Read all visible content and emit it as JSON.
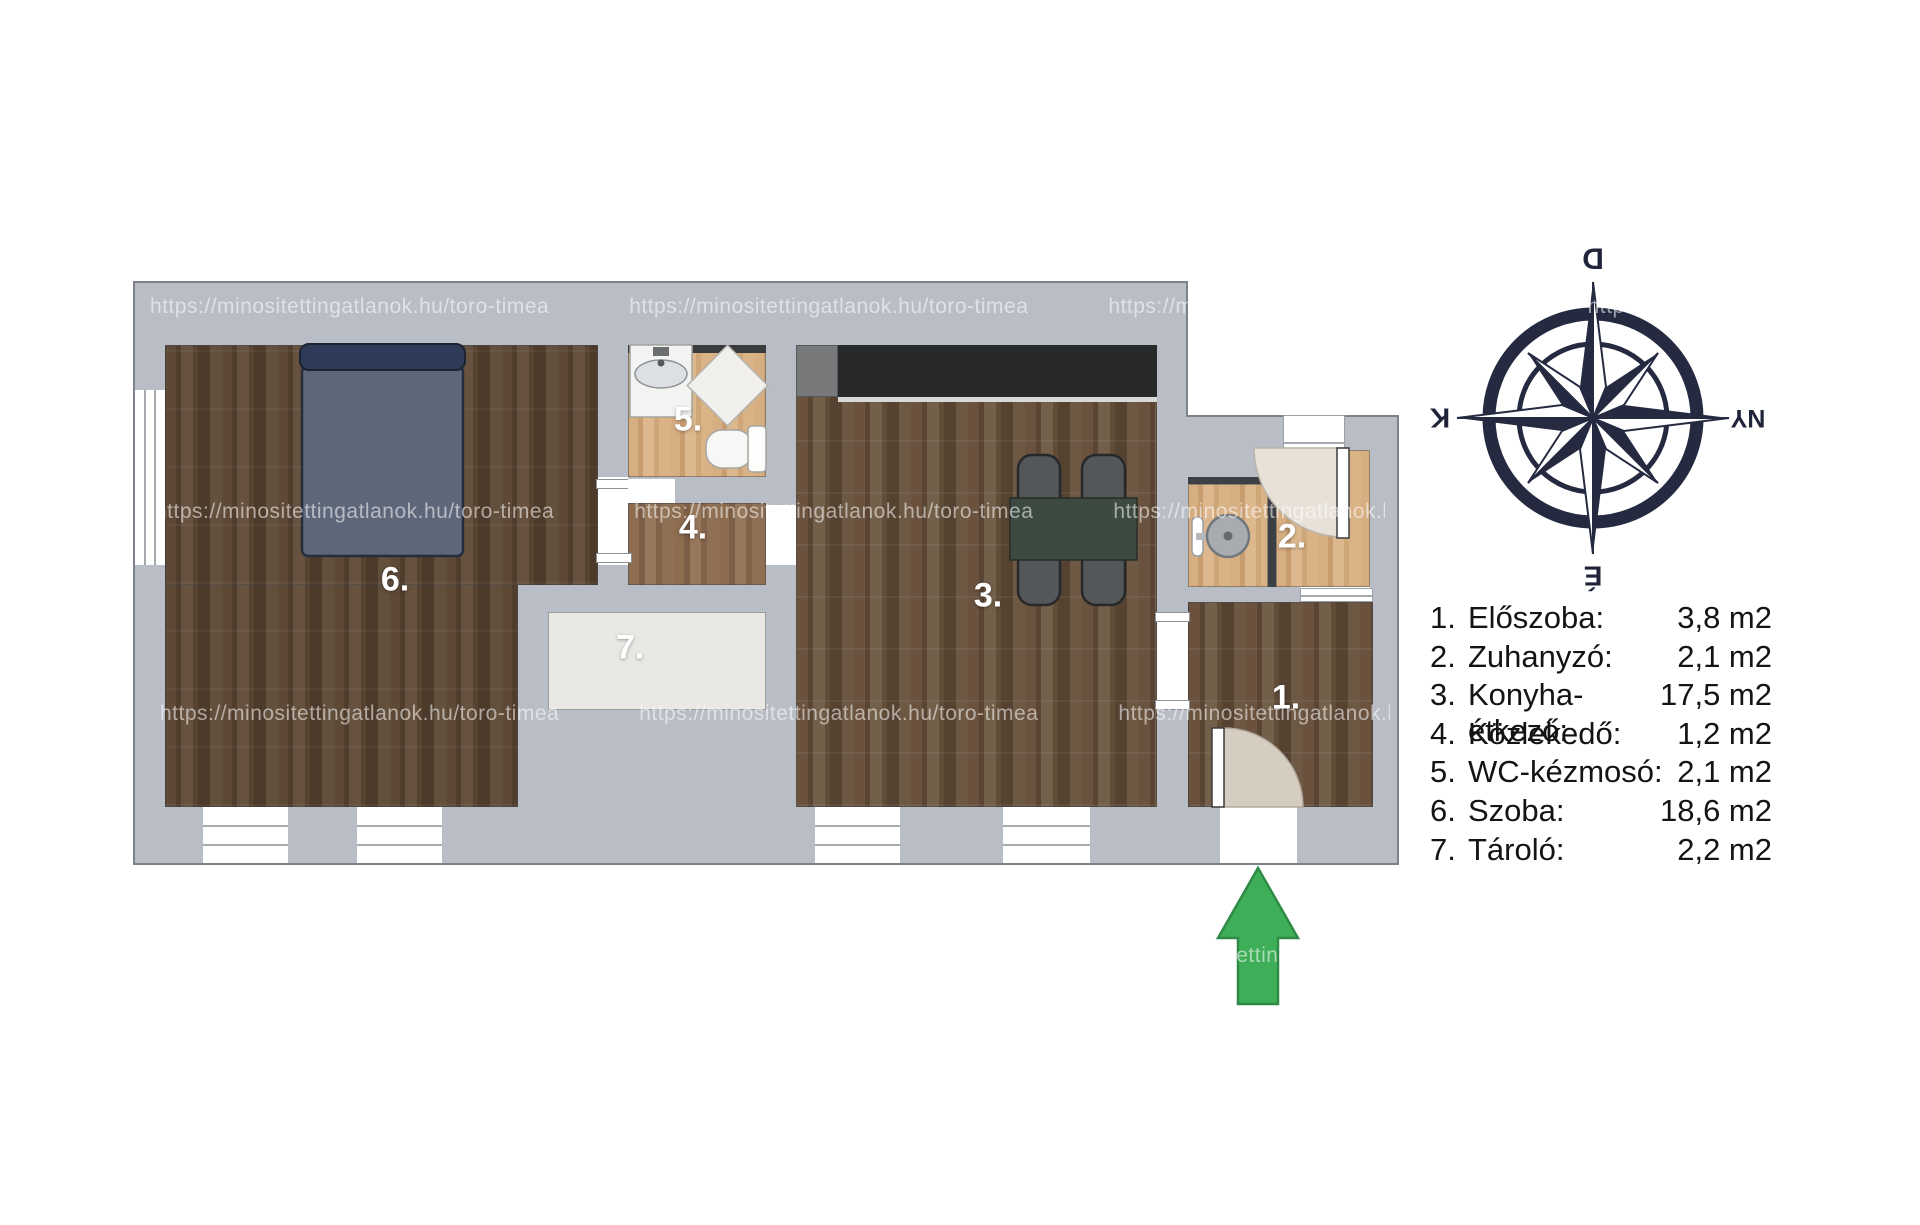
{
  "watermark": {
    "text": "https://minositettingatlanok.hu/toro-timea"
  },
  "compass": {
    "top": "D",
    "right": "NY",
    "bottom": "É",
    "left": "K"
  },
  "plan": {
    "room_labels": {
      "r1": "1.",
      "r2": "2.",
      "r3": "3.",
      "r4": "4.",
      "r5": "5.",
      "r6": "6.",
      "r7": "7."
    }
  },
  "legend": {
    "items": [
      {
        "num": "1.",
        "name": "Előszoba:",
        "area": "3,8 m2"
      },
      {
        "num": "2.",
        "name": "Zuhanyzó:",
        "area": "2,1 m2"
      },
      {
        "num": "3.",
        "name": "Konyha-étkező:",
        "area": "17,5 m2"
      },
      {
        "num": "4.",
        "name": "Közlekedő:",
        "area": "1,2 m2"
      },
      {
        "num": "5.",
        "name": "WC-kézmosó:",
        "area": "2,1 m2"
      },
      {
        "num": "6.",
        "name": "Szoba:",
        "area": "18,6 m2"
      },
      {
        "num": "7.",
        "name": "Tároló:",
        "area": "2,2 m2"
      }
    ]
  },
  "colors": {
    "wall_gray": "#b9bec6",
    "compass_navy": "#252a41",
    "arrow_green": "#3fae58",
    "kitchen_counter": "#27292b",
    "table_green": "#3c4a42",
    "bed_blue": "#2d3b58"
  }
}
